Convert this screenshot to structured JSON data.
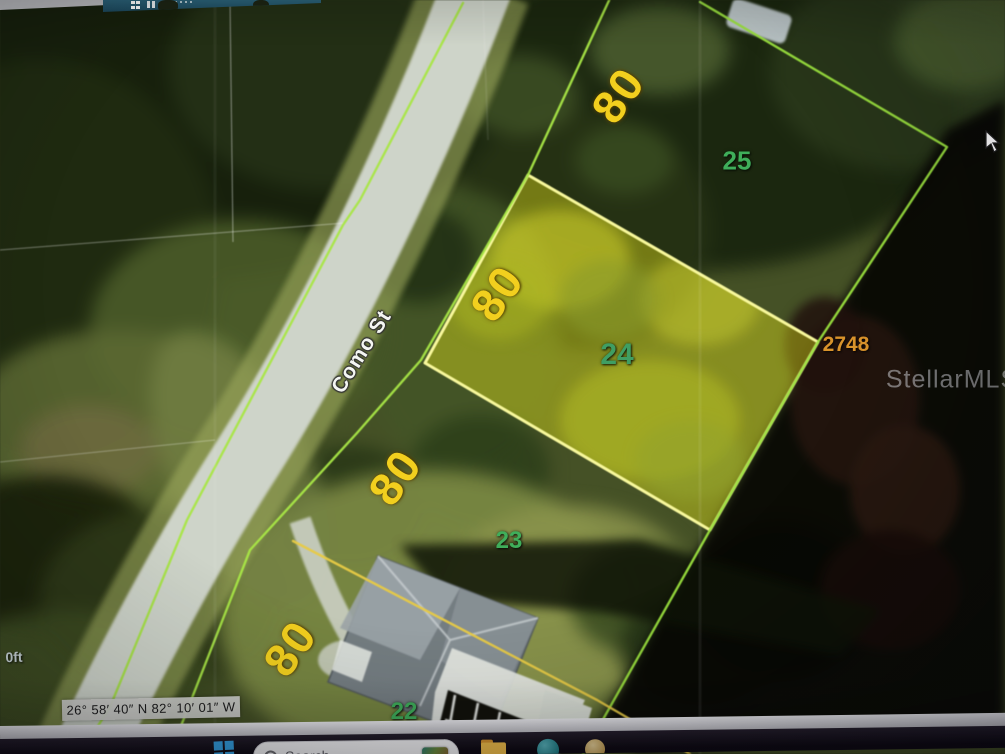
{
  "map": {
    "street_label": "Como St",
    "lot_size_labels": [
      "80",
      "80",
      "80",
      "80"
    ],
    "parcels": {
      "lot_25": "25",
      "lot_24": "24",
      "lot_23": "23",
      "lot_22": "22"
    },
    "address_number": "2748",
    "watermark": "StellarMLS",
    "scale_label": "0ft",
    "coordinates": "26° 58′ 40″ N 82° 10′ 01″ W",
    "colors": {
      "highlight_fill": "#e6e62e",
      "highlight_border": "#f2f29a",
      "boundary_green": "#a9e24f",
      "boundary_yellow": "#e3c84e",
      "lot_dimension_text": "#f2cf1e",
      "parcel_number_text": "#3fae5a",
      "address_text": "#d9932b"
    }
  },
  "taskbar": {
    "search_placeholder": "Search"
  }
}
